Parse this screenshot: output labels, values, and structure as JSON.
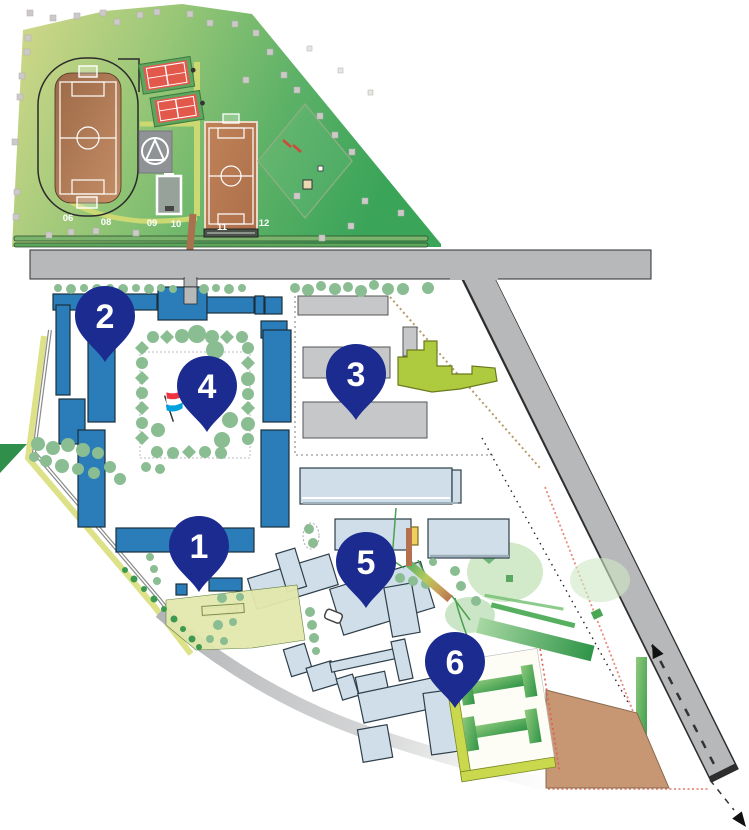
{
  "map": {
    "name": "school-campus-site-map",
    "markers": [
      {
        "id": "1",
        "x": 199,
        "y": 592
      },
      {
        "id": "2",
        "x": 105,
        "y": 362
      },
      {
        "id": "3",
        "x": 356,
        "y": 420
      },
      {
        "id": "4",
        "x": 207,
        "y": 432
      },
      {
        "id": "5",
        "x": 366,
        "y": 608
      },
      {
        "id": "6",
        "x": 455,
        "y": 708
      }
    ],
    "field_labels": [
      {
        "text": "06",
        "x": 68,
        "y": 221
      },
      {
        "text": "08",
        "x": 106,
        "y": 225
      },
      {
        "text": "09",
        "x": 152,
        "y": 226
      },
      {
        "text": "10",
        "x": 176,
        "y": 227
      },
      {
        "text": "11",
        "x": 222,
        "y": 230
      },
      {
        "text": "12",
        "x": 264,
        "y": 226
      }
    ],
    "colors": {
      "pin": "#1b2b8f",
      "pin_text": "#ffffff",
      "building_blue": "#2b7db9",
      "building_gray": "#c5c7c9",
      "building_pale": "#cfdee8",
      "building_lime": "#aecb3f",
      "road": "#b6b8ba",
      "park_green": "#44a55c",
      "park_yellow": "#d6d98b",
      "tree_green": "#8abd92",
      "court_red": "#e2594c",
      "pitch_brown": "#b5784f",
      "sand_brown": "#c79673",
      "flag_red": "#ee3340",
      "flag_white": "#ffffff",
      "flag_blue": "#00a2de"
    }
  }
}
